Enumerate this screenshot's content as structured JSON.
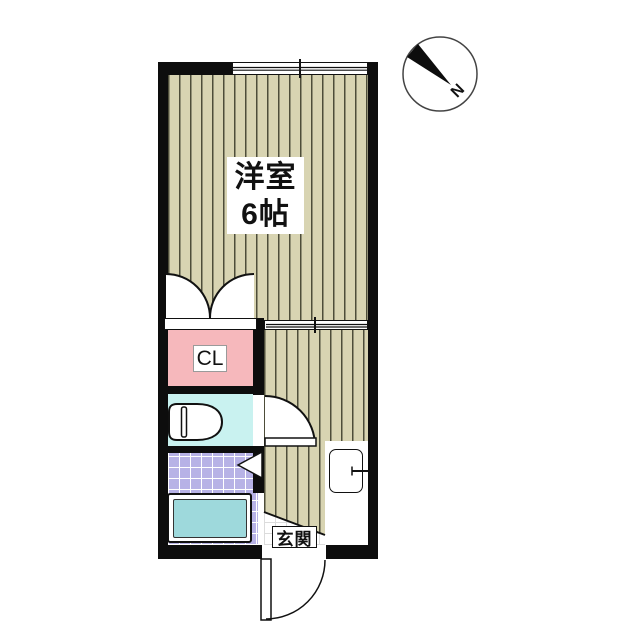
{
  "floorplan": {
    "main_room": {
      "line1": "洋室",
      "line2": "6帖",
      "full_label": "洋室 6帖"
    },
    "closet_label": "CL",
    "entrance_label": "玄関",
    "compass_label": "N",
    "colors": {
      "wall": "#0d0d0d",
      "flooring_base": "#d8d4b2",
      "flooring_stripe": "#3e3e2c",
      "closet_pink": "#f6b8bc",
      "toilet_cyan": "#c9f2f0",
      "bath_tile_lavender": "#b7b2e6",
      "bathtub_teal": "#9ed9dc",
      "entrance_tile_line": "#dcdcdc"
    }
  }
}
